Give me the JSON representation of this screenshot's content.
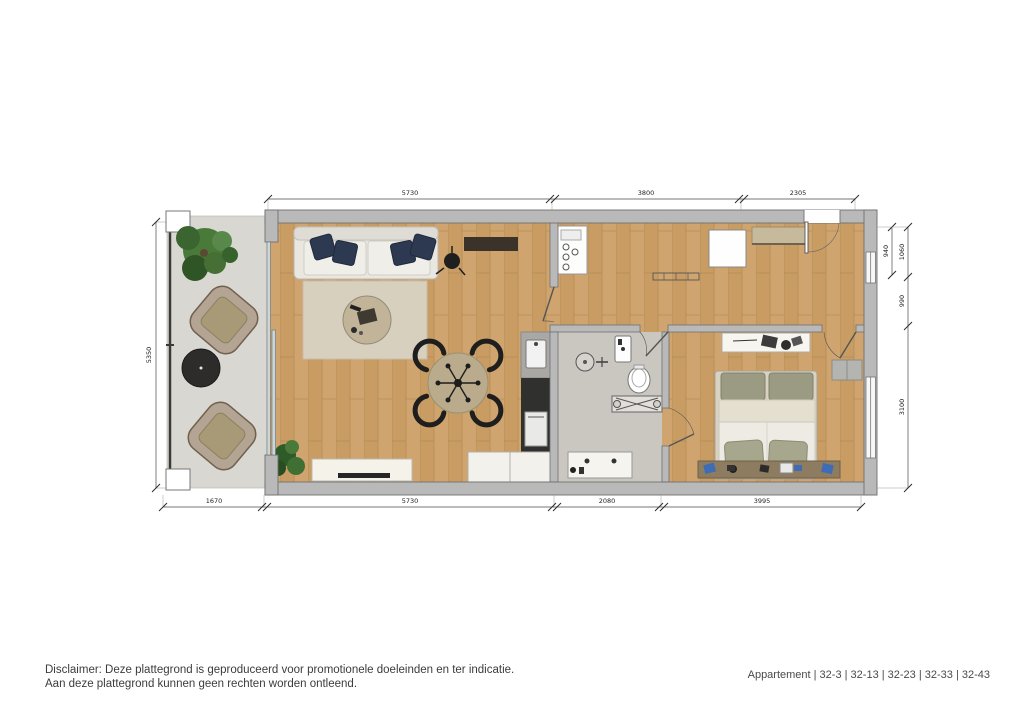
{
  "plan": {
    "dimensions": {
      "top": [
        "5730",
        "3800",
        "2305"
      ],
      "bottom": [
        "1670",
        "5730",
        "2080",
        "3995"
      ],
      "left": [
        "5350"
      ],
      "right_inner": [
        "940"
      ],
      "right_outer": [
        "1060",
        "990",
        "3100"
      ]
    },
    "colors": {
      "wood_floor": "#cfa46e",
      "balcony_floor": "#d9d7d1",
      "bathroom_floor": "#cac7c1",
      "wall": "#b9b9b9",
      "pillow_navy": "#2d3950"
    }
  },
  "footer": {
    "disclaimer_line1": "Disclaimer: Deze plattegrond is geproduceerd voor promotionele doeleinden en ter indicatie.",
    "disclaimer_line2": "Aan deze plattegrond kunnen geen rechten worden ontleend.",
    "apartment_label": "Appartement | 32-3 | 32-13 | 32-23 | 32-33 | 32-43"
  }
}
